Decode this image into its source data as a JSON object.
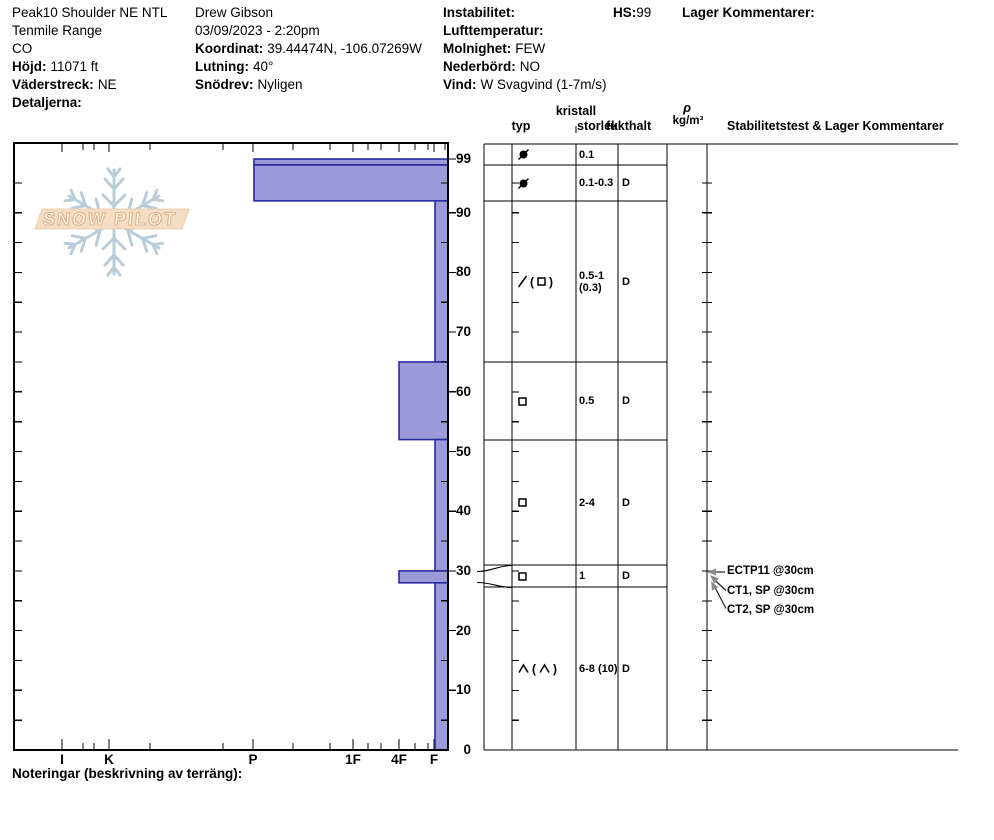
{
  "header": {
    "pit_name": "Peak10 Shoulder NE NTL",
    "range": "Tenmile Range",
    "state": "CO",
    "elevation": {
      "label": "Höjd:",
      "value": "11071 ft"
    },
    "aspect": {
      "label": "Väderstreck:",
      "value": "NE"
    },
    "details": {
      "label": "Detaljerna:",
      "value": ""
    },
    "observer": "Drew Gibson",
    "datetime": "03/09/2023 - 2:20pm",
    "coordinates": {
      "label": "Koordinat:",
      "value": "39.44474N, -106.07269W"
    },
    "slope": {
      "label": "Lutning:",
      "value": "40°"
    },
    "drifting": {
      "label": "Snödrev:",
      "value": "Nyligen"
    },
    "instability": {
      "label": "Instabilitet:",
      "value": ""
    },
    "air_temp": {
      "label": "Lufttemperatur:",
      "value": ""
    },
    "sky": {
      "label": "Molnighet:",
      "value": "FEW"
    },
    "precip": {
      "label": "Nederbörd:",
      "value": "NO"
    },
    "wind": {
      "label": "Vind:",
      "value": "W Svagvind (1-7m/s)"
    },
    "hs": {
      "label": "HS:",
      "value": "99"
    },
    "layer_comments": {
      "label": "Lager Kommentarer:",
      "value": ""
    }
  },
  "logo": {
    "text": "SNOW PILOT"
  },
  "table_header": {
    "typ": "typ",
    "kristall": "kristall",
    "storlek": "storlek",
    "fukthalt": "fukthalt",
    "rho": "ρ",
    "rho_unit": "kg/m³",
    "stability": "Stabilitetstest & Lager Kommentarer"
  },
  "chart_data": {
    "type": "bar",
    "subtype": "snow-hardness-profile",
    "hardness_labels": [
      "I",
      "K",
      "P",
      "1F",
      "4F",
      "F"
    ],
    "height_ticks_cm": [
      99,
      90,
      80,
      70,
      60,
      50,
      40,
      30,
      20,
      10,
      0
    ],
    "total_depth_cm": 99,
    "layers": [
      {
        "top_cm": 99,
        "bottom_cm": 98,
        "hardness": "P",
        "grain": "circle-slash",
        "size_mm": "0.1",
        "size_mm_2": "",
        "moisture": ""
      },
      {
        "top_cm": 98,
        "bottom_cm": 92,
        "hardness": "P",
        "grain": "circle-slash",
        "size_mm": "0.1-0.3",
        "size_mm_2": "",
        "moisture": "D"
      },
      {
        "top_cm": 92,
        "bottom_cm": 65,
        "hardness": "F",
        "grain": "slash(square)",
        "size_mm": "0.5-1",
        "size_mm_2": "(0.3)",
        "moisture": "D"
      },
      {
        "top_cm": 65,
        "bottom_cm": 52,
        "hardness": "4F",
        "grain": "square",
        "size_mm": "0.5",
        "size_mm_2": "",
        "moisture": "D"
      },
      {
        "top_cm": 52,
        "bottom_cm": 30,
        "hardness": "F",
        "grain": "square",
        "size_mm": "2-4",
        "size_mm_2": "",
        "moisture": "D"
      },
      {
        "top_cm": 30,
        "bottom_cm": 28,
        "hardness": "4F",
        "grain": "square",
        "size_mm": "1",
        "size_mm_2": "",
        "moisture": "D"
      },
      {
        "top_cm": 28,
        "bottom_cm": 0,
        "hardness": "F",
        "grain": "caret(caret)",
        "size_mm": "6-8 (10)",
        "size_mm_2": "",
        "moisture": "D"
      }
    ],
    "stability_tests": [
      {
        "label": "ECTP11 @30cm"
      },
      {
        "label": "CT1, SP @30cm"
      },
      {
        "label": "CT2, SP @30cm"
      }
    ]
  },
  "footer": {
    "notes_label": "Noteringar (beskrivning av terräng):"
  },
  "colors": {
    "bar_fill": "#9b9bd9",
    "bar_stroke": "#2929a3",
    "snowflake": "#b9ccd9",
    "banner": "#f4ddc4",
    "banner_edge": "#eccfae",
    "arrow_gray": "#8a8a8a",
    "line": "#000000"
  }
}
